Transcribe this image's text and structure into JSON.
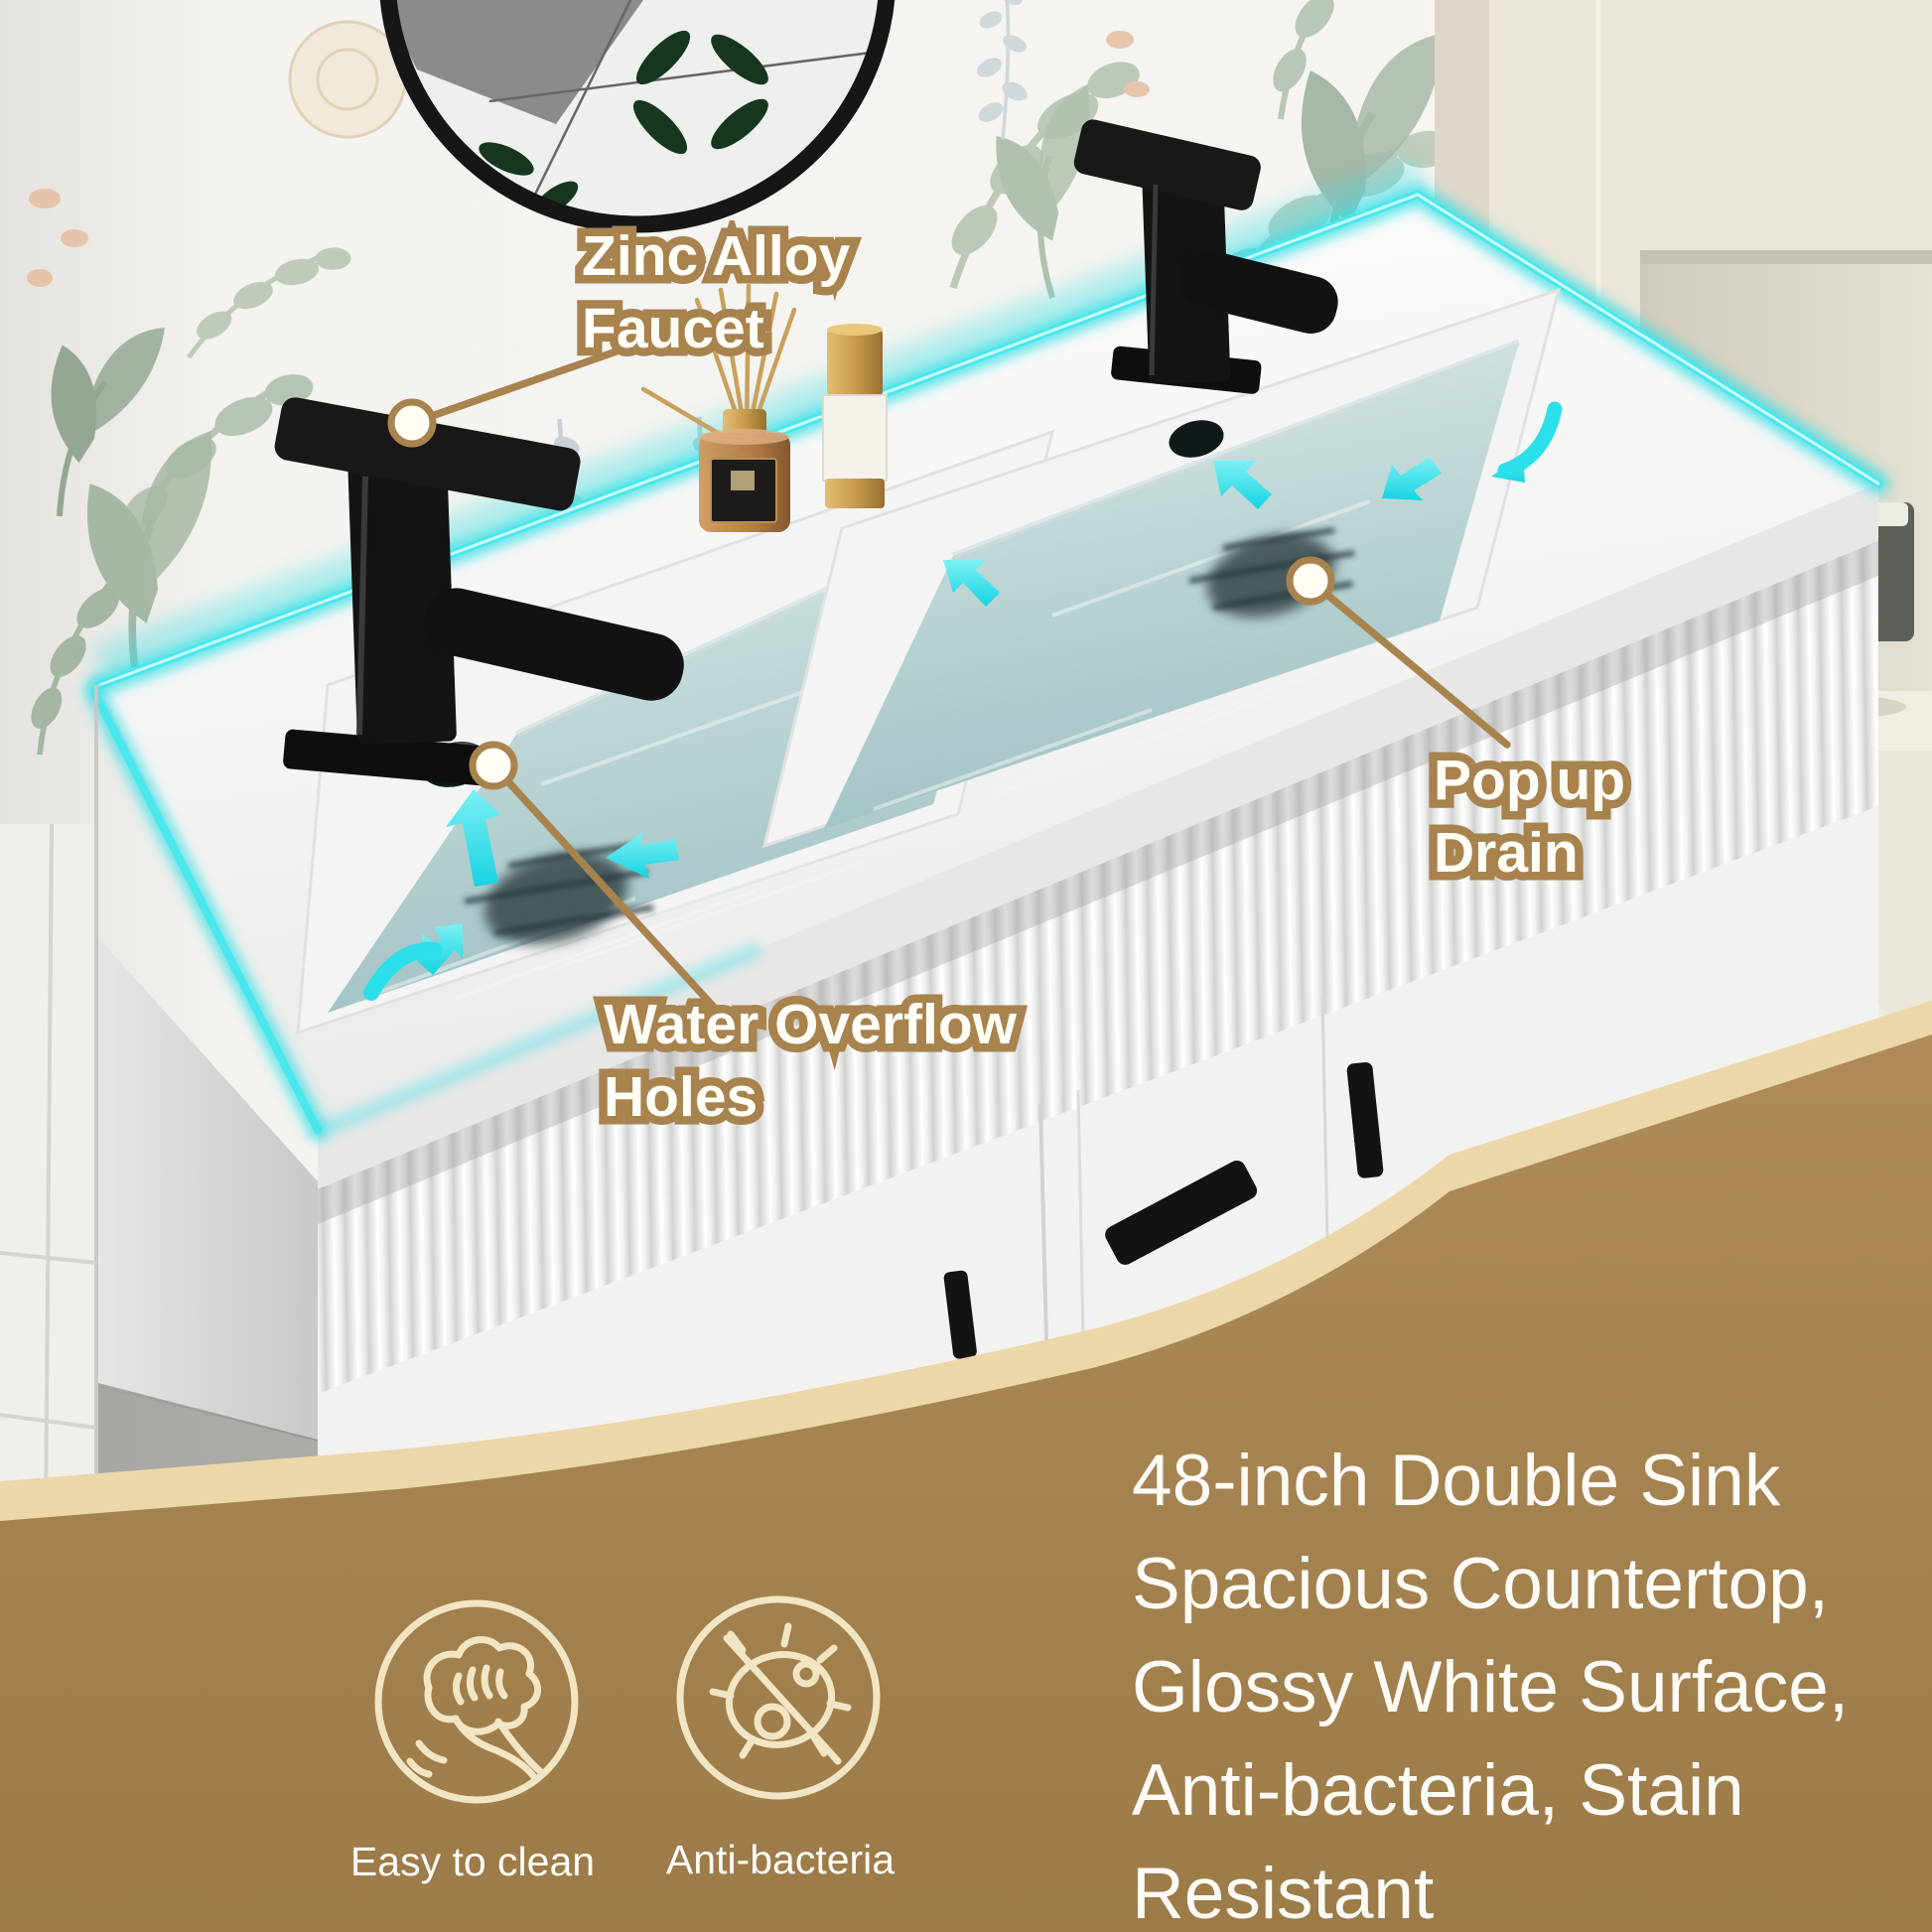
{
  "callouts": {
    "zinc_alloy_faucet": {
      "line1": "Zinc Alloy",
      "line2": "Faucet"
    },
    "pop_up_drain": {
      "line1": "Pop up",
      "line2": "Drain"
    },
    "water_overflow_holes": {
      "line1": "Water Overflow",
      "line2": "Holes"
    }
  },
  "features": [
    {
      "icon": "wipe-hand-icon",
      "label": "Easy to clean"
    },
    {
      "icon": "anti-bacteria-icon",
      "label": "Anti-bacteria"
    }
  ],
  "description": {
    "lines": [
      "48-inch Double Sink",
      "Spacious Countertop,",
      "Glossy White Surface,",
      "Anti-bacteria, Stain",
      "Resistant"
    ]
  },
  "colors": {
    "accent_cyan": "#35e0e6",
    "callout_tan": "#a8834e",
    "banner_brown_top": "#ae8b58",
    "banner_brown_bottom": "#9c7b48",
    "banner_cream_edge": "#ecd7a8",
    "icon_stroke": "#f2e5c3",
    "text_white": "#fcfbf6"
  }
}
